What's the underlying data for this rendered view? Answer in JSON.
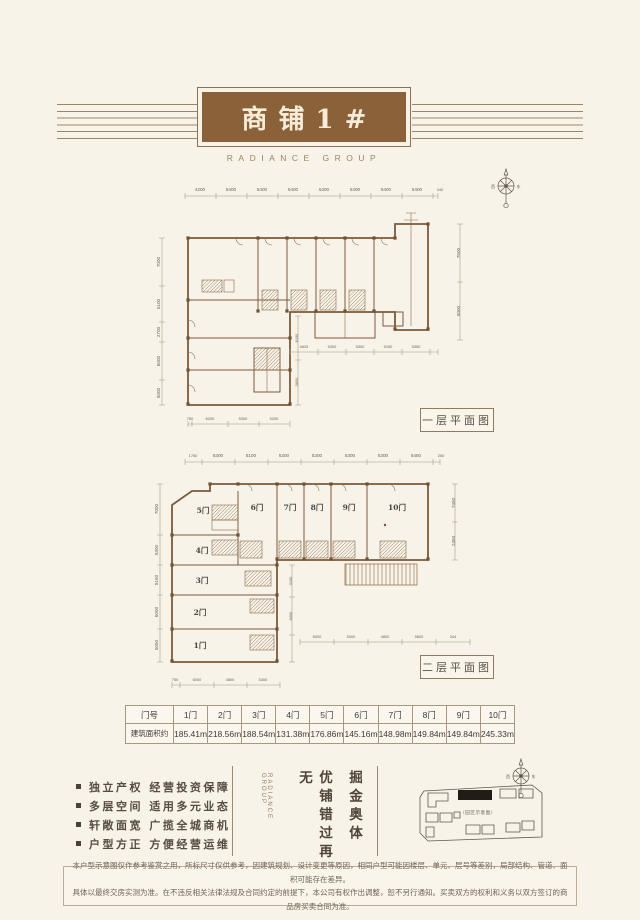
{
  "header": {
    "title": "商铺1#",
    "brand": "RADIANCE GROUP"
  },
  "plan1": {
    "label": "一层平面图",
    "dims_top": [
      "4200",
      "5400",
      "5400",
      "5400",
      "5400",
      "5400",
      "5400",
      "5400",
      "240"
    ],
    "dims_left": [
      "7000",
      "5100",
      "2700",
      "6000",
      "5000"
    ],
    "dims_right": [
      "7500",
      "5000"
    ],
    "dims_inner_v": [
      "6150",
      "5850"
    ],
    "dims_mid": [
      "4625",
      "5300",
      "5300",
      "5150",
      "5350"
    ],
    "dims_bottom": [
      "750",
      "6200",
      "5300",
      "5200"
    ]
  },
  "plan2": {
    "label": "二层平面图",
    "dims_top": [
      "1750",
      "5300",
      "5100",
      "5300",
      "5300",
      "5300",
      "5300",
      "5450",
      "250"
    ],
    "dims_left": [
      "7000",
      "5300",
      "5150",
      "6000",
      "5050"
    ],
    "dims_right": [
      "7450",
      "2450"
    ],
    "dims_inner_v": [
      "3150",
      "6000"
    ],
    "dims_mid": [
      "5000",
      "5000",
      "4800",
      "5600",
      "344"
    ],
    "dims_bottom": [
      "750",
      "6000",
      "4800",
      "5300"
    ],
    "units": [
      "1门",
      "2门",
      "3门",
      "4门",
      "5门",
      "6门",
      "7门",
      "8门",
      "9门",
      "10门"
    ]
  },
  "table": {
    "header": [
      "门号",
      "1门",
      "2门",
      "3门",
      "4门",
      "5门",
      "6门",
      "7门",
      "8门",
      "9门",
      "10门"
    ],
    "row_label": "建筑面积约",
    "areas": [
      "185.41m²",
      "218.56m²",
      "188.54m²",
      "131.38m²",
      "176.86m²",
      "145.16m²",
      "148.98m²",
      "149.84m²",
      "149.84m²",
      "245.33m²"
    ]
  },
  "features": {
    "items": [
      "独立产权 经营投资保障",
      "多层空间 适用多元业态",
      "轩敞面宽 广揽全城商机",
      "户型方正 方便经营运维"
    ]
  },
  "slogan": {
    "col_right": "掘金奥体",
    "col_left": "优铺错过再无",
    "brand_vertical": "RADIANCE GROUP"
  },
  "compass": {
    "west": "西",
    "east": "东"
  },
  "sitemap": {
    "caption": "（园区示意图）"
  },
  "disclaimer": {
    "line1": "本户型示意图仅作参考鉴赏之用，所标尺寸仅供参考，因建筑规划、设计变更等原因，相同户型可能因楼层、单元、层号等差别，局部结构、管道、面积可能存在差异。",
    "line2": "具体以最终交房实测为准。在不违反相关法律法规及合同约定的前提下，本公司有权作出调整，恕不另行通知。买卖双方的权利和义务以双方签订的商品房买卖合同为准。"
  }
}
